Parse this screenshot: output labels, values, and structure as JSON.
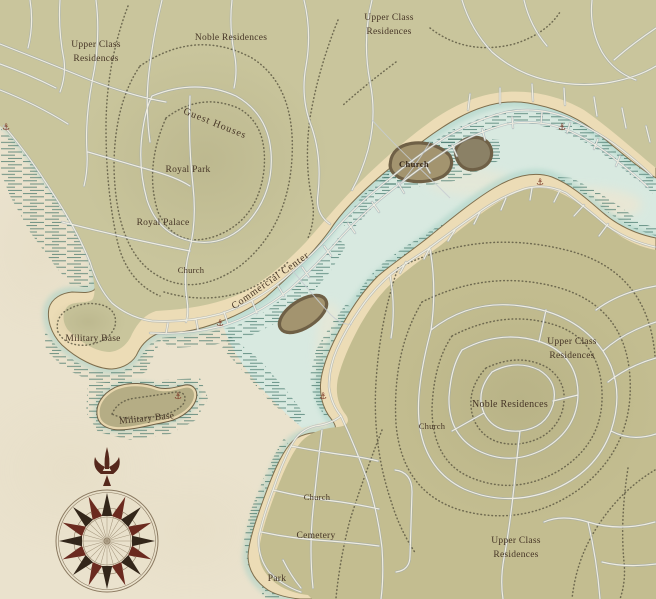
{
  "palette": {
    "parchment": "#eae2cd",
    "land": "#c9c59c",
    "land_b": "#c3bd90",
    "sand": "#ecdcb6",
    "coast_line": "#7e6e4d",
    "water": "#d7e9e0",
    "hatch": "#3a6f63",
    "road_casing": "#9aa6b2",
    "road_fill": "#f2efe2",
    "contour": "#5f5a44",
    "ink": "#463526",
    "anchor": "#7c3a28",
    "compass_dark": "#33261a",
    "compass_red": "#6b2a1f",
    "compass_ring": "#8a7960"
  },
  "map": {
    "labels": {
      "ucr_nw": {
        "lines": [
          "Upper Class",
          "Residences"
        ]
      },
      "noble_n": {
        "text": "Noble Residences"
      },
      "ucr_n": {
        "lines": [
          "Upper Class",
          "Residences"
        ]
      },
      "guest_houses": {
        "text": "Guest Houses"
      },
      "royal_park": {
        "text": "Royal Park"
      },
      "royal_palace": {
        "text": "Royal Palace"
      },
      "church_a": {
        "text": "Church"
      },
      "commercial_center": {
        "text": "Commercial Center"
      },
      "church_island": {
        "text": "Church"
      },
      "military_w": {
        "text": "Military Base"
      },
      "military_island": {
        "text": "Military Base"
      },
      "ucr_e": {
        "lines": [
          "Upper Class",
          "Residences"
        ]
      },
      "noble_e": {
        "text": "Noble Residences"
      },
      "church_e": {
        "text": "Church"
      },
      "ucr_s": {
        "lines": [
          "Upper Class",
          "Residences"
        ]
      },
      "church_s": {
        "text": "Church"
      },
      "cemetery": {
        "text": "Cemetery"
      },
      "park": {
        "text": "Park"
      }
    },
    "markers": {
      "anchor_glyph": "⚓"
    }
  }
}
